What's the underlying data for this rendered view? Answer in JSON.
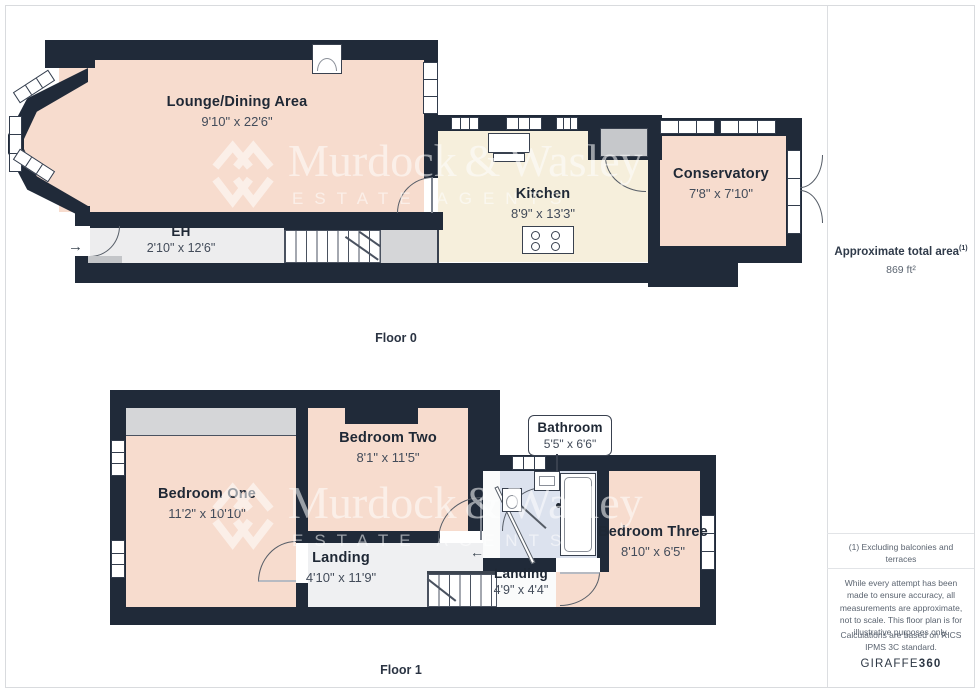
{
  "watermark": {
    "brand_left": "Murdock",
    "ampersand": "&",
    "brand_right": "Wasley",
    "tagline": "ESTATE AGENTS"
  },
  "icons": {
    "entrance_arrow": "→",
    "stairs_up_arrow": "←"
  },
  "floor0": {
    "label": "Floor 0",
    "rooms": {
      "lounge": {
        "name": "Lounge/Dining Area",
        "dims": "9'10\" x 22'6\""
      },
      "eh": {
        "name": "EH",
        "dims": "2'10\" x 12'6\""
      },
      "kitchen": {
        "name": "Kitchen",
        "dims": "8'9\" x 13'3\""
      },
      "conservatory": {
        "name": "Conservatory",
        "dims": "7'8\" x 7'10\""
      }
    }
  },
  "floor1": {
    "label": "Floor 1",
    "rooms": {
      "bedroom_one": {
        "name": "Bedroom One",
        "dims": "11'2\" x 10'10\""
      },
      "bedroom_two": {
        "name": "Bedroom Two",
        "dims": "8'1\" x 11'5\""
      },
      "bathroom": {
        "name": "Bathroom",
        "dims": "5'5\" x 6'6\""
      },
      "bedroom_three": {
        "name": "Bedroom Three",
        "dims": "8'10\" x 6'5\""
      },
      "landing": {
        "name": "Landing",
        "dims": "4'10\" x 11'9\""
      },
      "landing_small": {
        "name": "Landing",
        "dims": "4'9\" x 4'4\""
      }
    }
  },
  "sidebar": {
    "total_area_label": "Approximate total area",
    "total_area_ref": "(1)",
    "total_area_value": "869 ft²",
    "footnote": "(1) Excluding balconies and terraces",
    "disclaimer": "While every attempt has been made to ensure accuracy, all measurements are approximate, not to scale. This floor plan is for illustrative purposes only.",
    "standard_note": "Calculations are based on RICS IPMS 3C standard.",
    "brand_normal": "GIRAFFE",
    "brand_bold": "360"
  },
  "colors": {
    "wall": "#202a39",
    "room_warm": "#f7dcce",
    "room_cream": "#f6efdc",
    "hall_gray": "#ededee",
    "bathroom_blue": "#dce2ee"
  }
}
